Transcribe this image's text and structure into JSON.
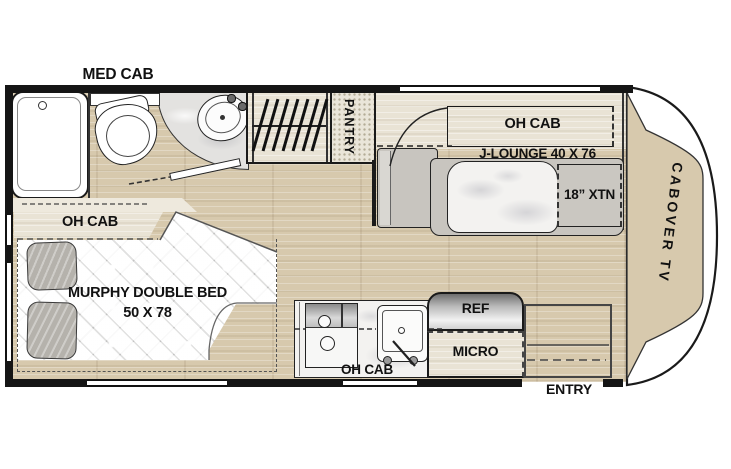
{
  "title": "RV floor plan",
  "colors": {
    "wall": "#151515",
    "floor_wood": "#d7c9ad",
    "floor_wood_light": "#e9e3d5",
    "tile": "#e3e2e0",
    "mattress_white": "#f5f5f4",
    "upholstery_gray": "#c8c5bf",
    "pillow_gray": "#b5b2ac",
    "stainless": "#9c9c9c",
    "label_text": "#111111"
  },
  "areas": {
    "bathroom": {
      "med_cab": "MED CAB"
    },
    "pantry": {
      "label": "PANTRY"
    },
    "lounge": {
      "oh_cab": "OH CAB",
      "j_lounge": "J-LOUNGE 40 X 76",
      "extension": "18” XTN"
    },
    "cab": {
      "cabover_tv": "CABOVER TV"
    },
    "bedroom": {
      "oh_cab": "OH CAB",
      "bed_line1": "MURPHY DOUBLE BED",
      "bed_line2": "50 X 78"
    },
    "kitchen": {
      "ref": "REF",
      "micro": "MICRO",
      "oh_cab": "OH CAB"
    },
    "entry": {
      "label": "ENTRY"
    }
  }
}
